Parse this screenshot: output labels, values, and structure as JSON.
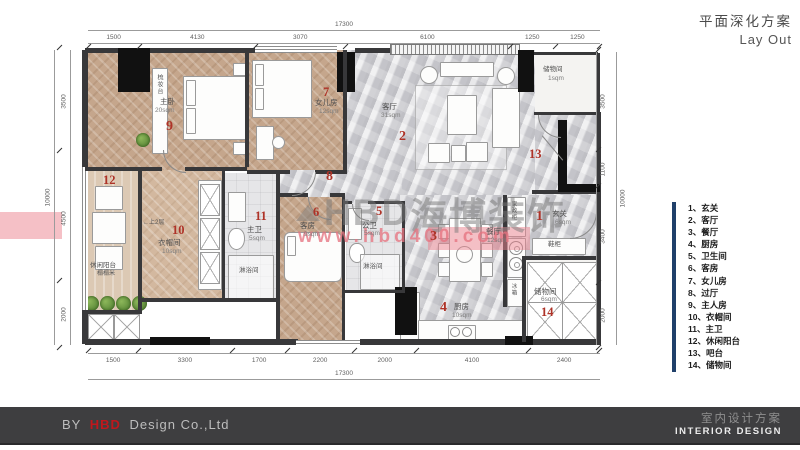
{
  "title": {
    "cn": "平面深化方案",
    "en": "Lay Out"
  },
  "legend": {
    "items": [
      {
        "num": "1、",
        "name": "玄关"
      },
      {
        "num": "2、",
        "name": "客厅"
      },
      {
        "num": "3、",
        "name": "餐厅"
      },
      {
        "num": "4、",
        "name": "厨房"
      },
      {
        "num": "5、",
        "name": "卫生间"
      },
      {
        "num": "6、",
        "name": "客房"
      },
      {
        "num": "7、",
        "name": "女儿房"
      },
      {
        "num": "8、",
        "name": "过厅"
      },
      {
        "num": "9、",
        "name": "主人房"
      },
      {
        "num": "10、",
        "name": "衣帽间"
      },
      {
        "num": "11、",
        "name": "主卫"
      },
      {
        "num": "12、",
        "name": "休闲阳台"
      },
      {
        "num": "13、",
        "name": "吧台"
      },
      {
        "num": "14、",
        "name": "储物间"
      }
    ]
  },
  "rooms": {
    "master": {
      "num": "9",
      "name": "主卧",
      "area": "20sqm"
    },
    "girl": {
      "num": "7",
      "name": "女儿房",
      "area": "12sqm"
    },
    "living": {
      "num": "2",
      "name": "客厅",
      "area": "31sqm"
    },
    "hall": {
      "num": "8"
    },
    "foyer": {
      "num": "1",
      "name": "玄关",
      "area": "6sqm"
    },
    "dining": {
      "num": "3",
      "name": "餐厅",
      "area": "12sqm"
    },
    "kitchen": {
      "num": "4",
      "name": "厨房",
      "area": "10sqm"
    },
    "pubbath": {
      "num": "5",
      "name": "公卫",
      "area": "5sqm"
    },
    "guest": {
      "num": "6",
      "name": "客房",
      "area": "9sqm"
    },
    "closet": {
      "num": "10",
      "name": "衣帽间",
      "area": "10sqm"
    },
    "mbath": {
      "num": "11",
      "name": "主卫",
      "area": "5sqm"
    },
    "balcony": {
      "num": "12",
      "name": "休闲阳台",
      "note": "榻榻米"
    },
    "bar": {
      "num": "13"
    },
    "storage": {
      "num": "14",
      "name": "储物间",
      "area": "6sqm"
    },
    "balcstore": {
      "name": "储物间",
      "area": "1sqm"
    }
  },
  "annotations": {
    "dressing_table": "梳妆台",
    "shoe_cabinet": "鞋柜",
    "shower1": "淋浴间",
    "shower2": "淋浴间",
    "stairs": "←上2层",
    "utility_cabinet": "家政柜",
    "fridge": "冰箱"
  },
  "watermark": {
    "logo": "HBD",
    "brand": "海博装饰",
    "url": "www.hbd400.com"
  },
  "dims": {
    "top": {
      "total": "17300",
      "segments": [
        1500,
        4130,
        3070,
        6100,
        1250,
        1250
      ]
    },
    "bottom": {
      "total": "17300",
      "segments": [
        1500,
        3300,
        1700,
        2200,
        2000,
        4100,
        2400
      ]
    },
    "left": {
      "total": "10000",
      "segments": [
        3500,
        4500,
        2000
      ]
    },
    "right": {
      "total": "10000",
      "segments": [
        3500,
        1100,
        3400,
        2000
      ]
    }
  },
  "footer": {
    "by": "BY",
    "brand": "HBD",
    "company": "Design Co.,Ltd",
    "right_cn": "室内设计方案",
    "right_en": "INTERIOR DESIGN"
  },
  "colors": {
    "accent_red": "#ae3328",
    "legend_bar": "#20406a",
    "footer_bg": "#3e3e40",
    "brand_red": "#c0171c"
  }
}
